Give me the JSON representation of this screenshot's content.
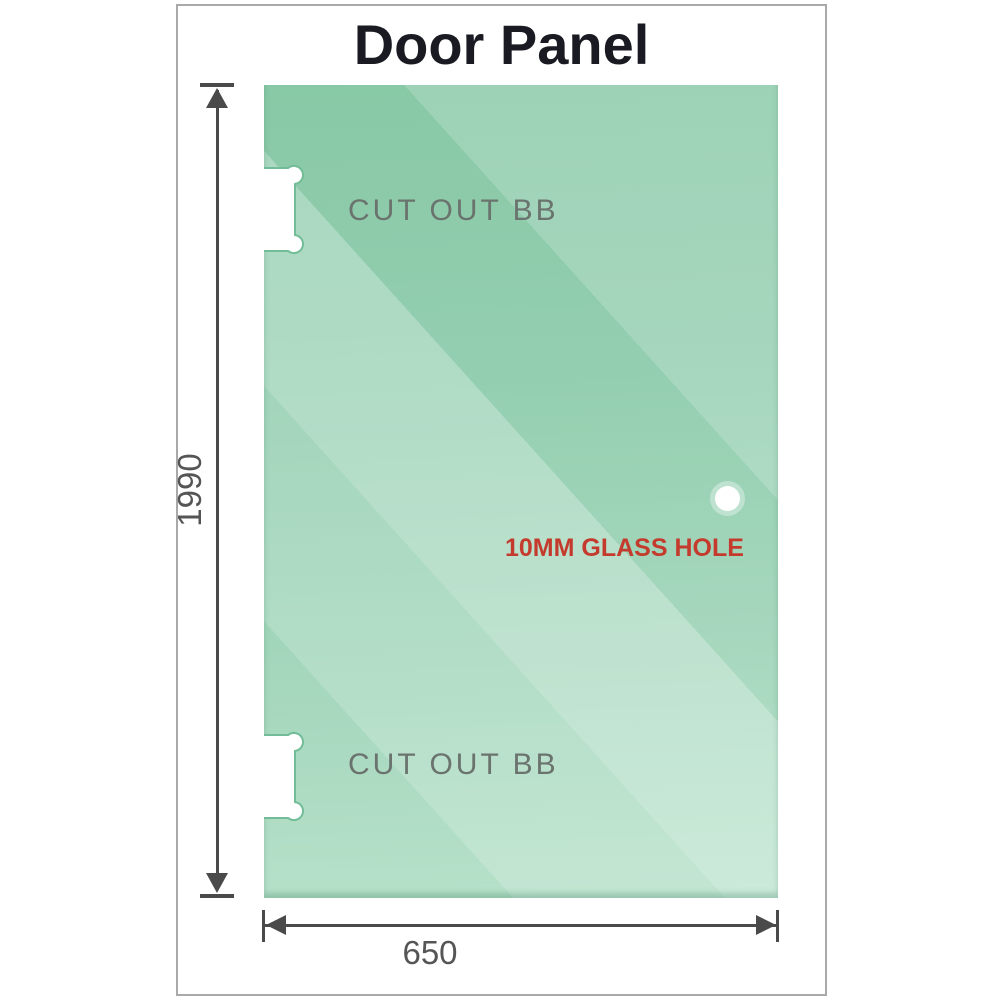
{
  "title": "Door Panel",
  "panel": {
    "glass_color": "#7ec49f",
    "glass_color_light": "#b4e0c8",
    "frame_color": "#a9a9a9"
  },
  "annotations": {
    "cutout_top_label": "CUT OUT BB",
    "cutout_bottom_label": "CUT OUT BB",
    "hole_label": "10MM GLASS HOLE",
    "hole_label_color": "#c43b2e",
    "cutout_label_color": "#6b736f"
  },
  "dimensions": {
    "height_label": "1990",
    "width_label": "650",
    "line_color": "#4a4a4a",
    "text_color": "#555555"
  }
}
